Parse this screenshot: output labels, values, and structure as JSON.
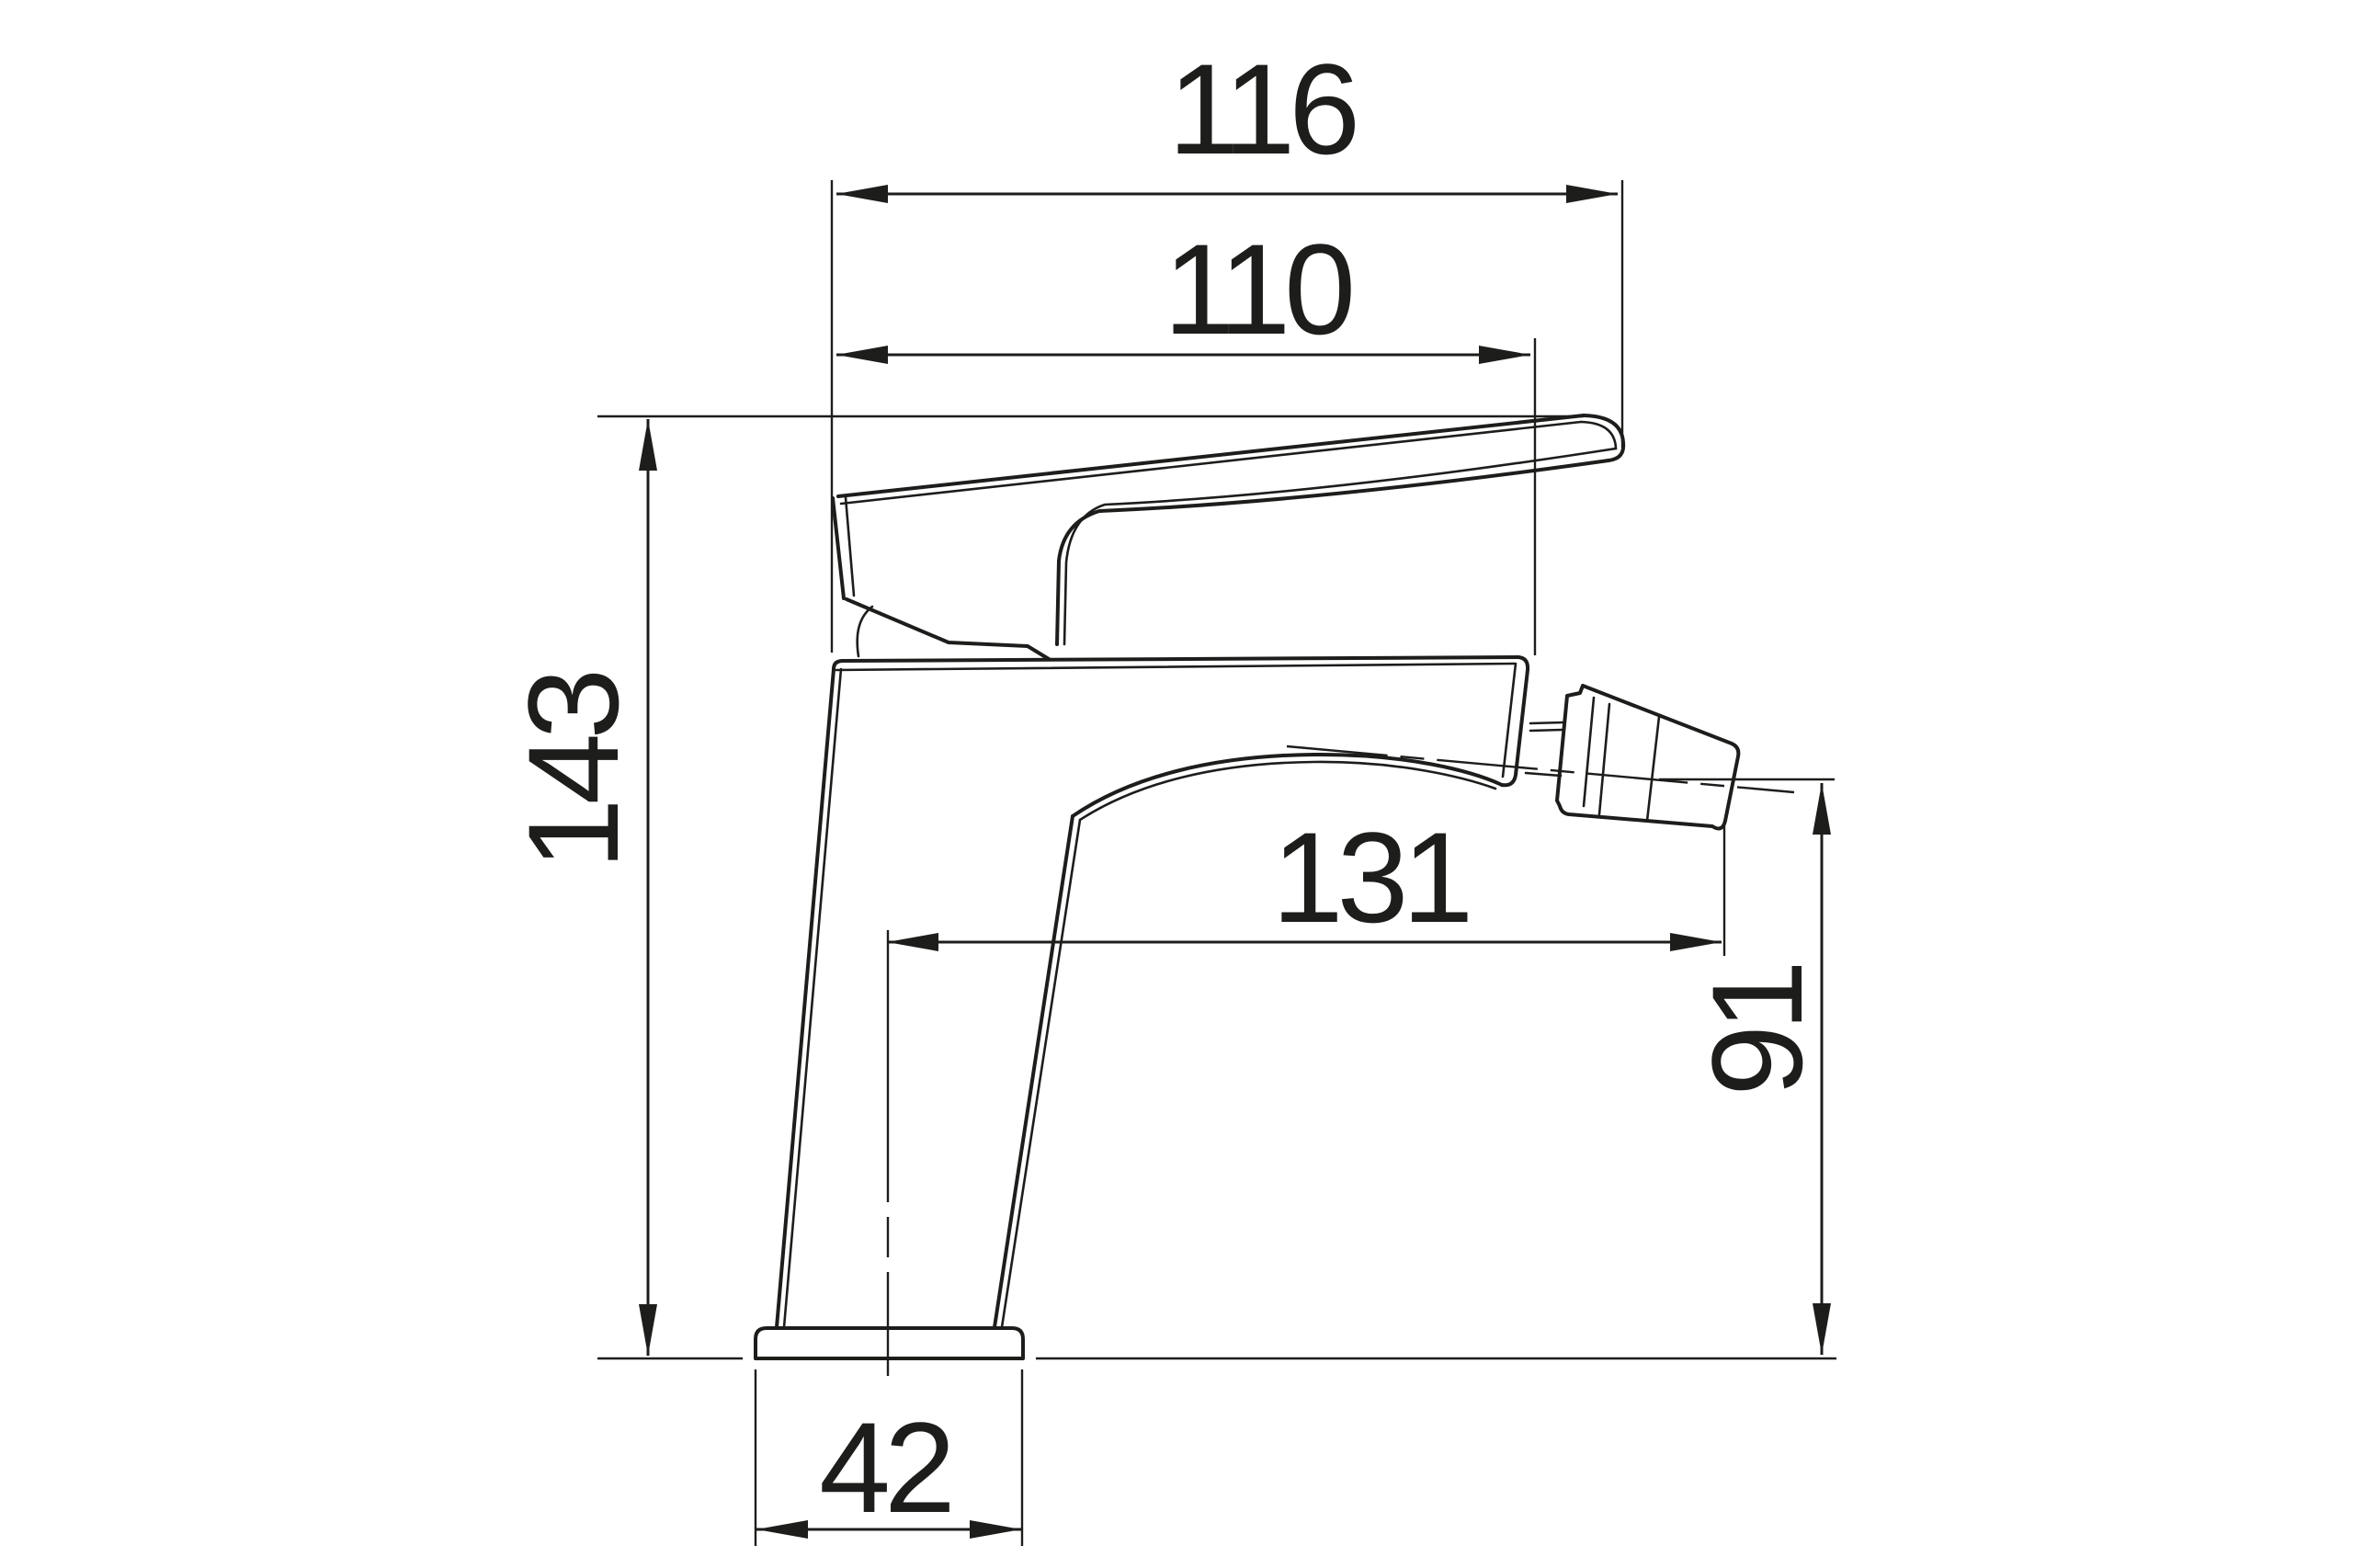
{
  "drawing": {
    "title": "Bidet mixer faucet - dimensioned side view",
    "type": "technical-dimension-drawing",
    "colors": {
      "line": "#1d1d1b",
      "background": "#ffffff"
    },
    "dimensions": {
      "overall_top_width": "116",
      "body_top_reach": "110",
      "total_height": "143",
      "spout_axis_reach": "131",
      "outlet_height": "91",
      "base_width": "42"
    }
  }
}
